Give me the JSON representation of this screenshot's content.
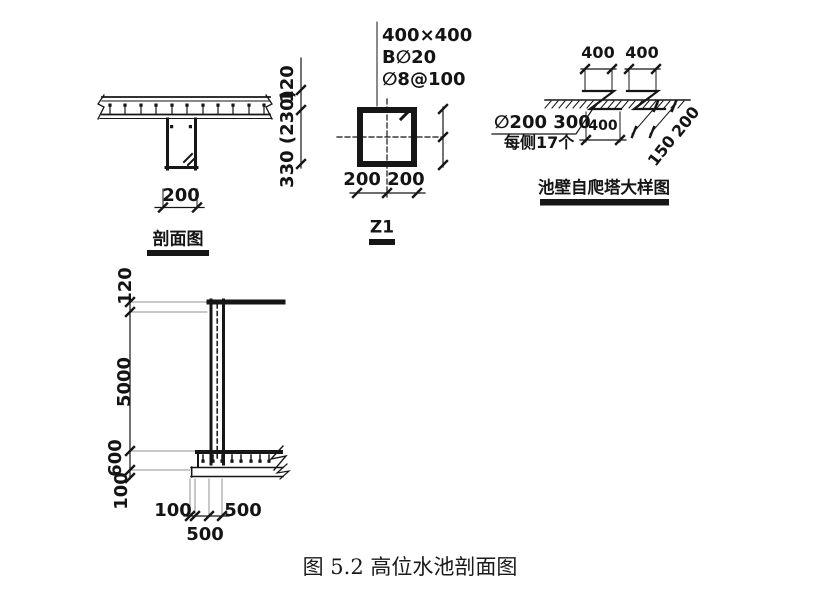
{
  "figure_caption": "图 5.2 高位水池剖面图",
  "section_view": {
    "title": "剖面图",
    "dim_width": "200",
    "dim_slab_thickness": "120",
    "dim_beam_depth": "330 (230)"
  },
  "column": {
    "title": "Z1",
    "note_size": "400×400",
    "note_main_bars": "B∅20",
    "note_stirrups": "∅8@100",
    "dim_bottom": "200 200"
  },
  "ladder_detail": {
    "title": "池壁自爬塔大样图",
    "dim_top_1": "400",
    "dim_top_2": "400",
    "note_rung_line1": "∅200 300",
    "note_rung_line2": "每侧17个",
    "dim_mid": "400",
    "dim_diag_lower": "150",
    "dim_diag_upper": "200"
  },
  "wall_section": {
    "dim_roof_slab": "120",
    "dim_wall_height": "5000",
    "dim_footing": "600",
    "dim_base": "100",
    "dim_h_edge": "100",
    "dim_h_right": "500",
    "dim_h_bottom": "500"
  }
}
